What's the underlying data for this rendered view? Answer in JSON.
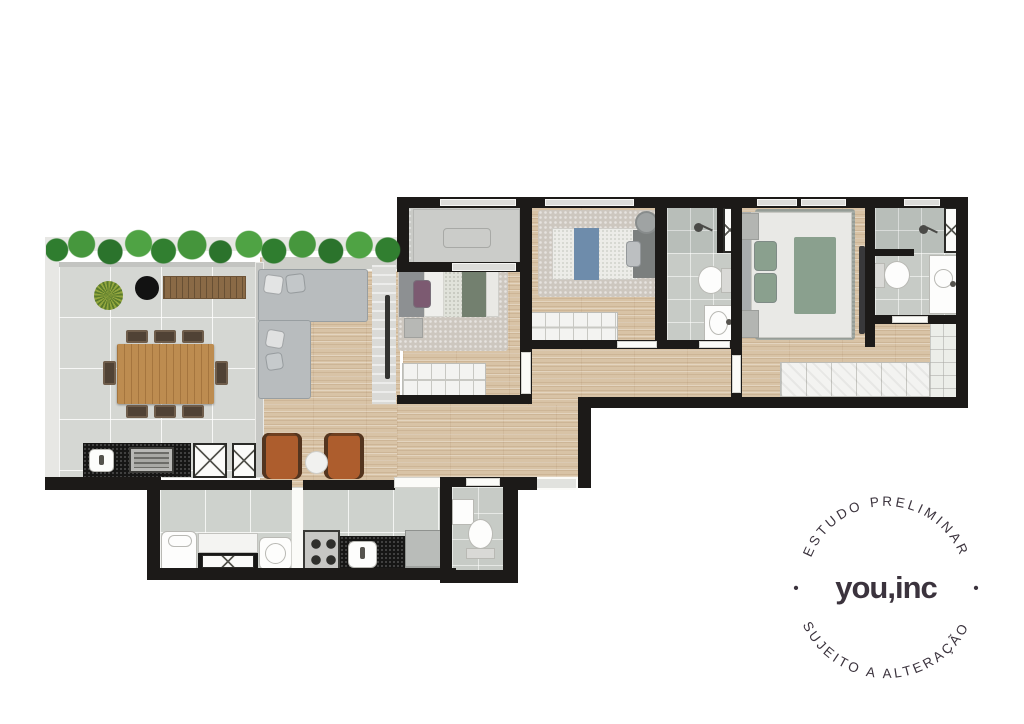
{
  "watermark": {
    "arc_top": "ESTUDO PRELIMINAR",
    "arc_bottom": "SUJEITO A ALTERAÇÃO",
    "brand": "you,inc",
    "separator_left": "•",
    "separator_right": "•"
  },
  "palette": {
    "wall": "#1c1a18",
    "watermark_color": "#3b333d",
    "wood_floor": "#d8c3a6",
    "terrace_tile": "#d5d7d3",
    "bath_tile": "#c7cbc6",
    "hedge_green": "#3e8c3c",
    "dining_table_wood": "#bd8c50",
    "sofa_gray": "#b8bcbe",
    "armchair_leather": "#ad5d2d",
    "bed_blue": "#6e8cab",
    "pillow_purple": "#7c5a71",
    "bed_sage_green": "#8aa08e",
    "counter_black": "#161615",
    "white_furniture": "#f4f4f2"
  }
}
